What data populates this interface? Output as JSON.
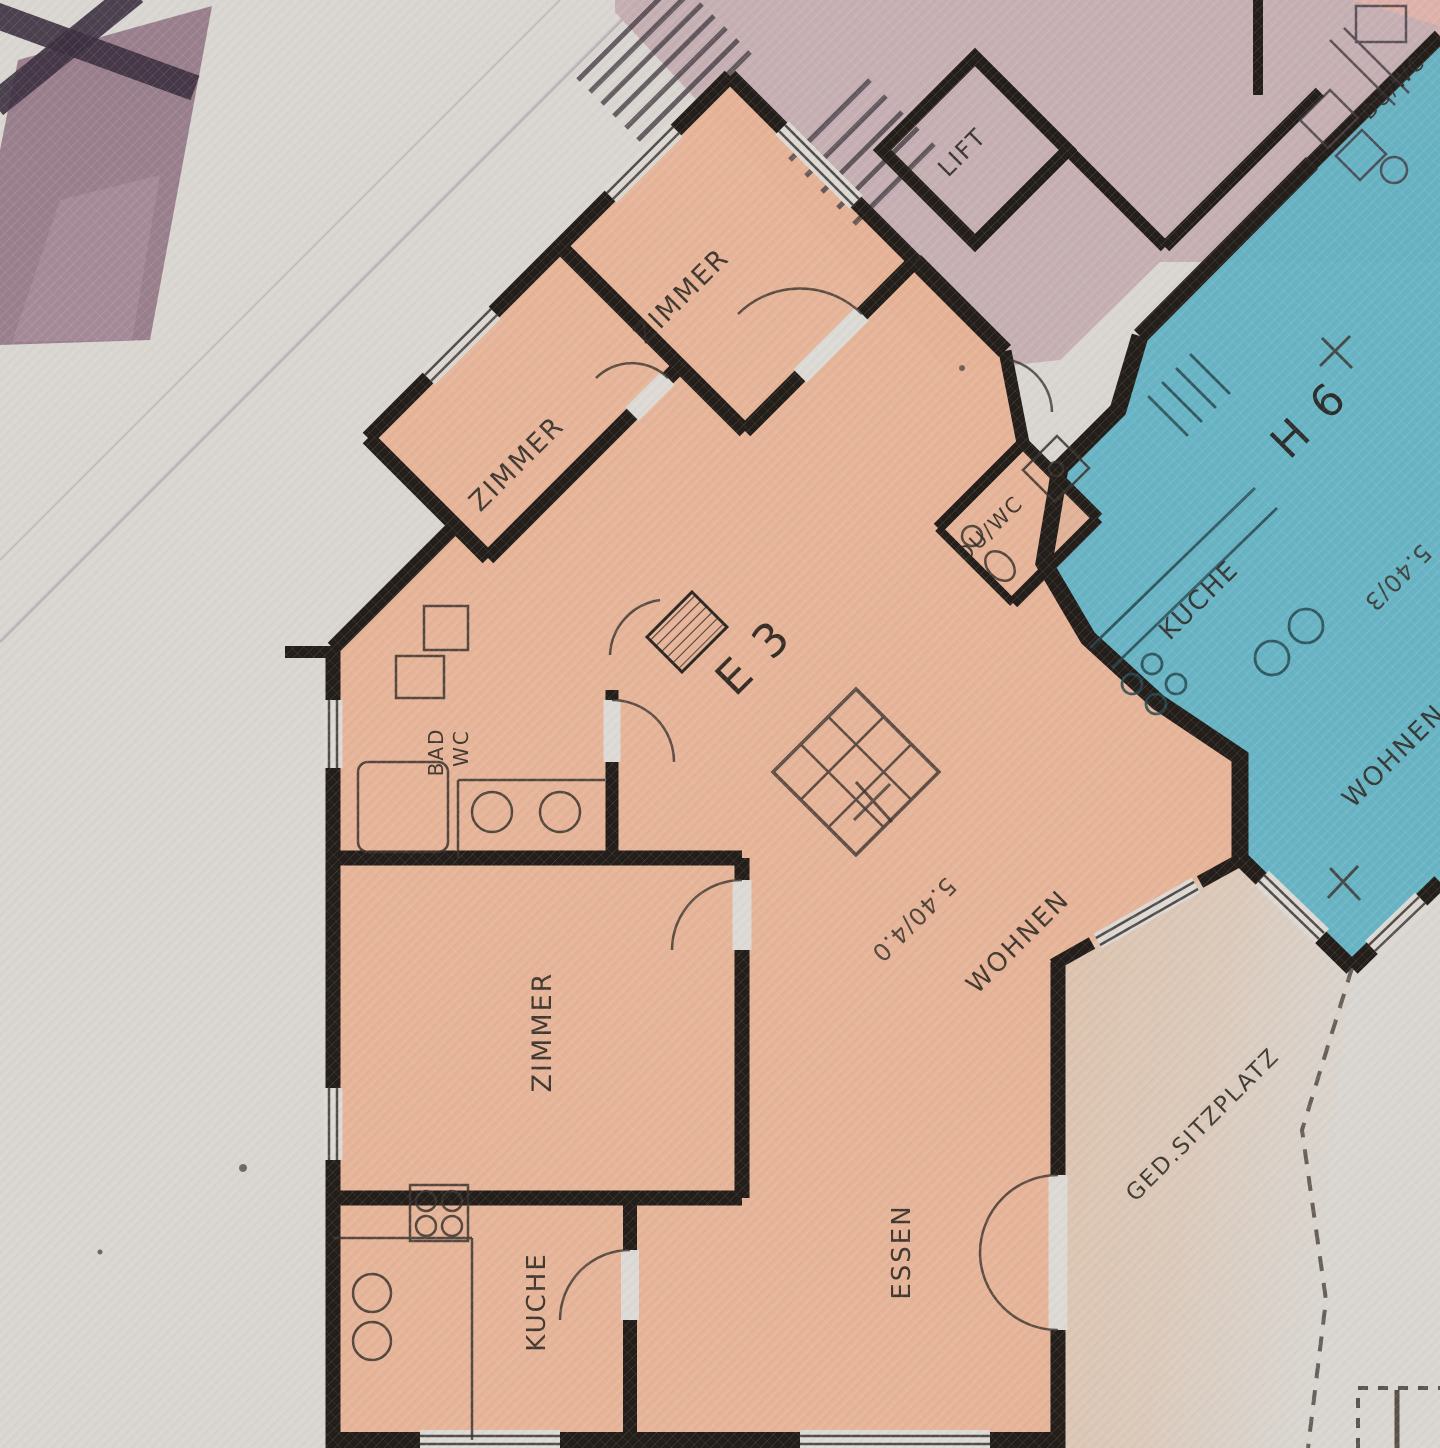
{
  "title": "Hand-coloured apartment floor plan (scanned architect drawing)",
  "palette": {
    "paper": "#d9d6d1",
    "apartment_e3": "#e7b295",
    "apartment_h6": "#62b2c3",
    "stair_core": "#c3abb0",
    "apartment_top_right": "#e2b3a8",
    "roof_band": "#8d7080",
    "terrace": "#ddbfa8",
    "wall": "#221d19",
    "ink": "#3a332e"
  },
  "labels": {
    "lift": {
      "text": "LIFT"
    },
    "zimmer_top": {
      "text": "ZIMMER"
    },
    "zimmer_left": {
      "text": "ZIMMER"
    },
    "zimmer_bottom": {
      "text": "ZIMMER"
    },
    "du_wc_e3": {
      "text": "DU/WC"
    },
    "du_wc_top_right": {
      "text": "DU/WC"
    },
    "bad": {
      "text": "BAD"
    },
    "wc": {
      "text": "WC"
    },
    "e3": {
      "text": "E 3"
    },
    "h6": {
      "text": "H 6"
    },
    "kuche_h6": {
      "text": "KUCHE"
    },
    "kuche_e3": {
      "text": "KUCHE"
    },
    "wohnen_h6": {
      "text": "WOHNEN"
    },
    "wohnen_e3": {
      "text": "WOHNEN"
    },
    "essen": {
      "text": "ESSEN"
    },
    "ged_sitzplatz": {
      "text": "GED.SITZPLATZ"
    },
    "dim_e3": {
      "text": "5.40/4.0"
    },
    "dim_h6": {
      "text": "5.40/3"
    }
  }
}
